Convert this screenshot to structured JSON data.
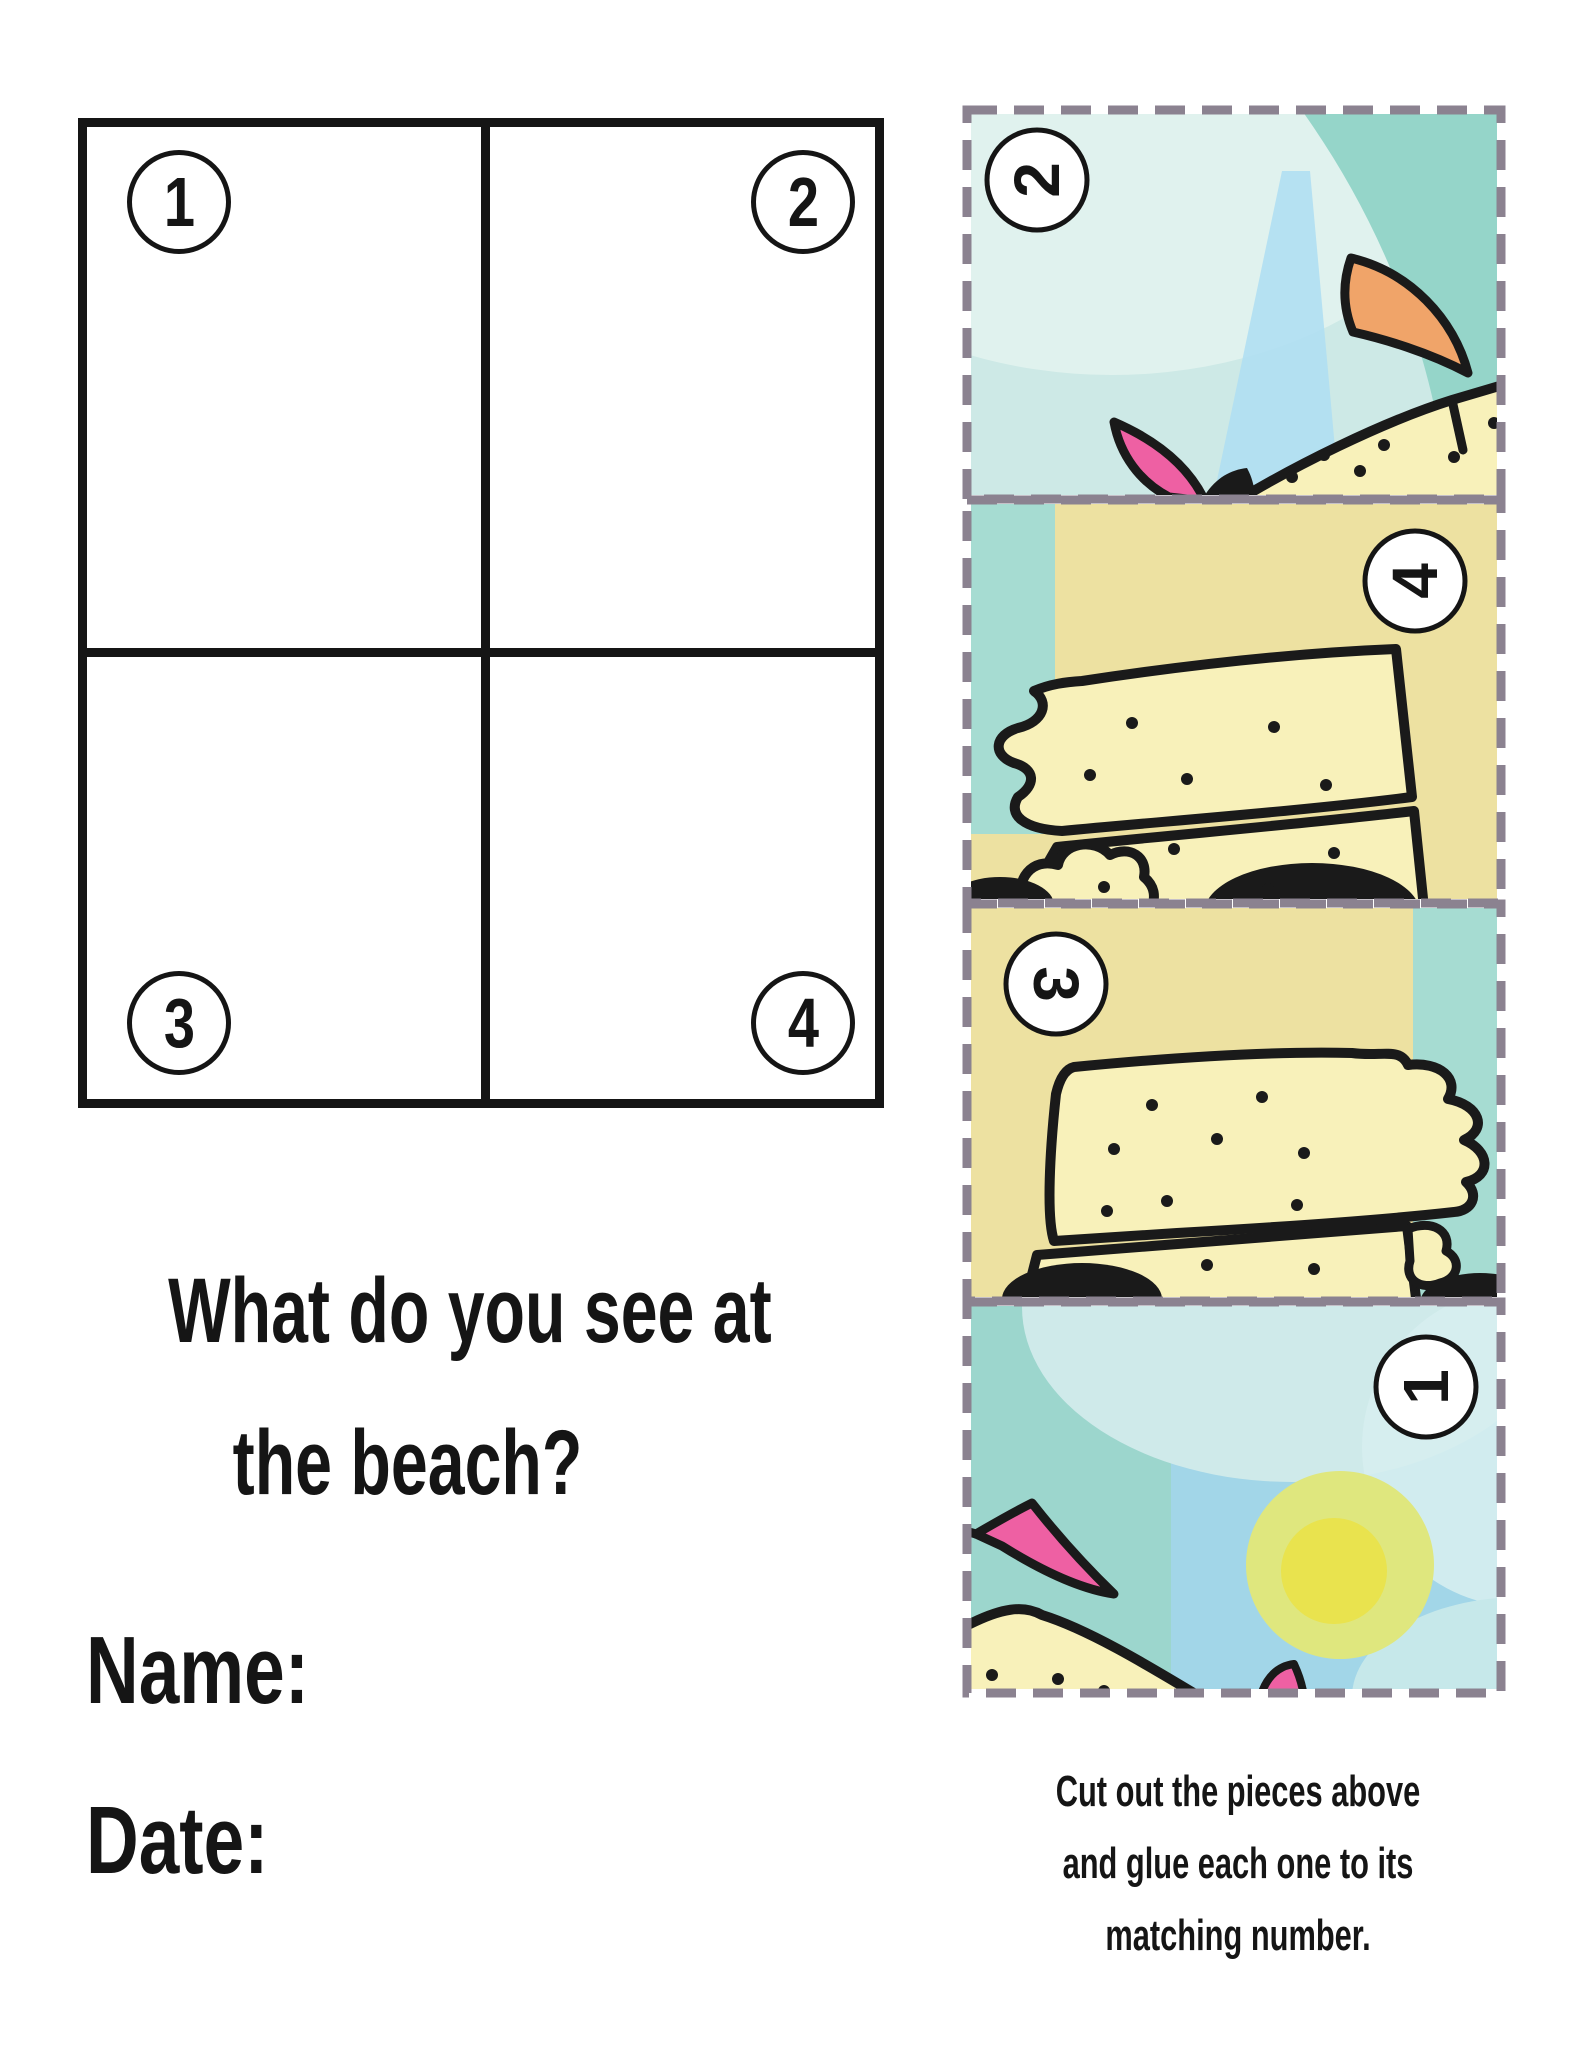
{
  "title": {
    "lines": [
      "What do you see at",
      "the beach?"
    ]
  },
  "fields": {
    "name_label": "Name:",
    "date_label": "Date:"
  },
  "grid": {
    "numbers": [
      "1",
      "2",
      "3",
      "4"
    ]
  },
  "pieces": [
    {
      "number": "2",
      "description": "sky piece with orange flag, pink flag tip and sandcastle top edge"
    },
    {
      "number": "4",
      "description": "sandcastle wall piece with melted left edge and shadow blobs"
    },
    {
      "number": "3",
      "description": "sandcastle wall piece with melted right edge and shadow blob"
    },
    {
      "number": "1",
      "description": "sky piece with sun, pink flag and sandcastle corner"
    }
  ],
  "instructions": {
    "lines": [
      "Cut out the pieces above",
      "and glue each one to its",
      "matching number."
    ]
  },
  "colors": {
    "page_background": "#ffffff",
    "ink": "#151515",
    "outline": "#1a1a1a",
    "dash_gray": "#8b8290",
    "sky_pale": "#cde9e6",
    "sky_lighter": "#e0f2ee",
    "sky_teal": "#95d5c9",
    "sky_blue_streak": "#b0dff2",
    "sky_blue": "#a2d6e8",
    "teal_left": "#9cd6cd",
    "pale_blob": "#cfeaea",
    "pale_blob2": "#d6eef0",
    "pale_corner": "#c6e8ea",
    "sand_bg": "#ede1a1",
    "sand_light": "#f8f1ba",
    "teal_strip": "#a6dcd2",
    "flag_orange": "#f0a469",
    "flag_pink": "#ee60a3",
    "sun_outer": "#dfe77e",
    "sun_inner": "#e9e34e"
  }
}
